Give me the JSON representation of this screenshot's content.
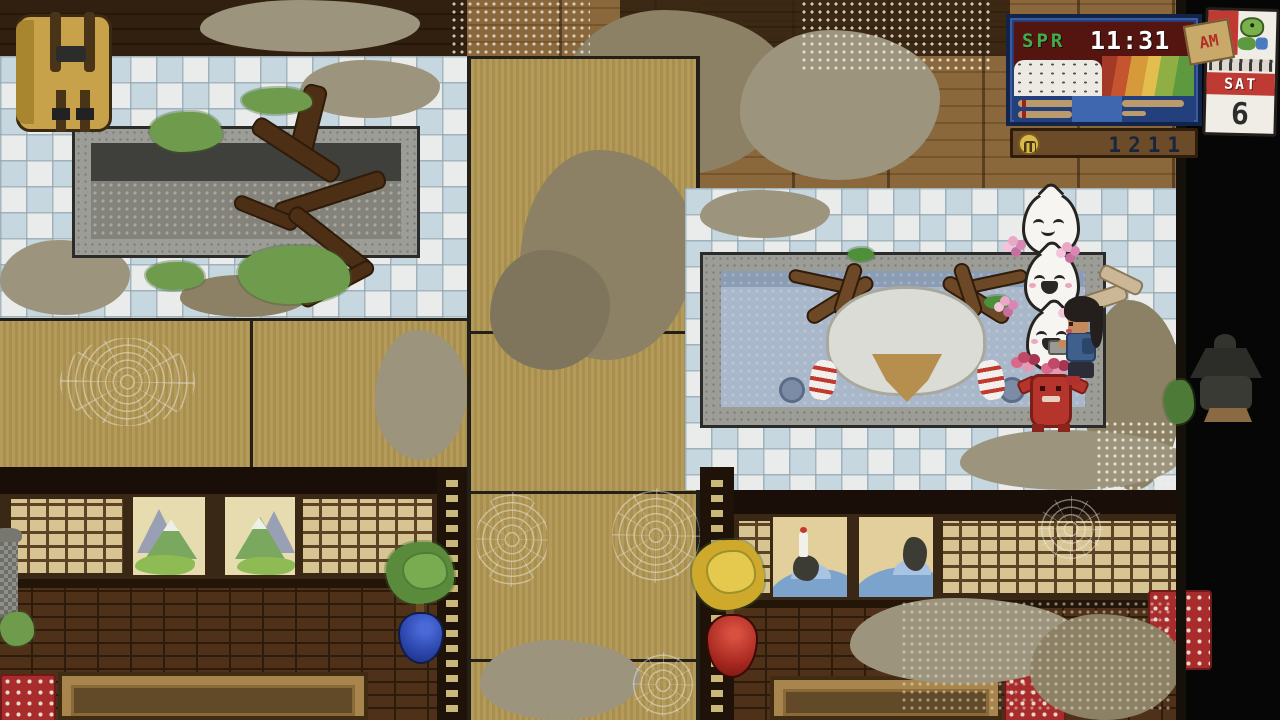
{
  "hud": {
    "season_label": "SPR",
    "time": "11:31",
    "meridiem": "AM",
    "money": "1211",
    "icons": {
      "money": "coin-icon",
      "meridiem_tag": "paper-tag",
      "calendar_mascot": "turtle-icon"
    },
    "colors": {
      "season_text": "#3fae49",
      "time_text": "#ffffff",
      "screen_bg": "#541410",
      "frame": "#12244a",
      "panel_bg": "#23407c",
      "bar_fill": "#bb9a6b",
      "bar_highlight": "#3f67b0",
      "plaque_bg": "#6b4b28",
      "money_text": "#18253f",
      "calendar_band": "#c03a34"
    }
  },
  "calendar": {
    "day": "SAT",
    "date": "6"
  },
  "scene": {
    "location": "abandoned-bathhouse-interior",
    "entities": [
      "backpack",
      "old-stone-bath",
      "tree-roots",
      "moss",
      "tatami-corridor",
      "tile-floor",
      "hot-bath",
      "deer-spirit",
      "spirit-stack-top",
      "spirit-stack-middle",
      "spirit-stack-bottom",
      "red-oni-spirit",
      "flower-blossoms",
      "player-character",
      "driftwood-spirit",
      "bath-drains",
      "stone-lantern-left",
      "stone-lantern-right",
      "bonsai-plant-blue-pot",
      "yellow-tree-red-pot",
      "mountain-painting-1",
      "mountain-painting-2",
      "wave-painting-1",
      "wave-painting-2",
      "shoji-screens",
      "brick-wall",
      "low-table-left",
      "low-table-right",
      "floor-cushion-left",
      "floor-cushion-right",
      "red-rug",
      "cobwebs",
      "dust-patches"
    ]
  }
}
